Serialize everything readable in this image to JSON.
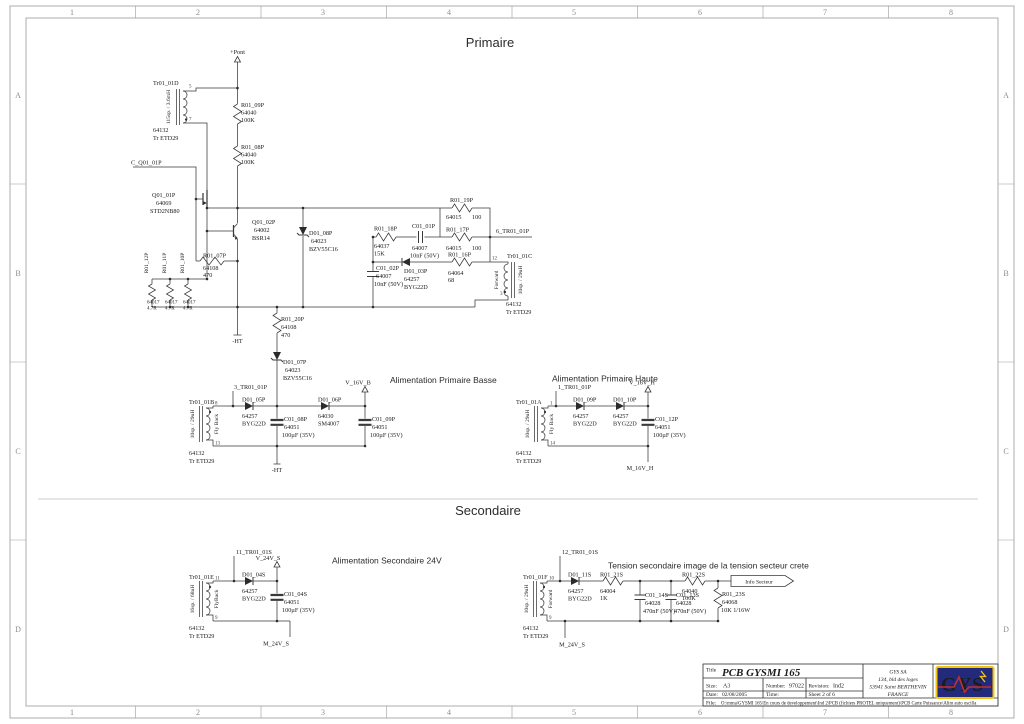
{
  "frame": {
    "columns": [
      "1",
      "2",
      "3",
      "4",
      "5",
      "6",
      "7",
      "8"
    ],
    "rows": [
      "A",
      "B",
      "C",
      "D"
    ]
  },
  "headers": {
    "primaire": "Primaire",
    "secondaire": "Secondaire",
    "alim_basse": "Alimentation Primaire Basse",
    "alim_haute": "Alimentation Primaire Haute",
    "alim_sec24": "Alimentation Secondaire 24V",
    "tension_sec": "Tension secondaire image de la tension secteur crete"
  },
  "nets": {
    "pont": "+Pont",
    "c_q01": "C_Q01_01P",
    "tr6": "6_TR01_01P",
    "tr3": "3_TR01_01P",
    "v16b": "V_16V_B",
    "tr1": "1_TR01_01P",
    "v16h": "V_16V_H",
    "m16h": "M_16V_H",
    "tr11": "11_TR01_01S",
    "v24": "V_24V_S",
    "m24": "M_24V_S",
    "tr12": "12_TR01_01S",
    "ht": "-HT",
    "info": "Info Secteur"
  },
  "components": {
    "tr01_01d": {
      "ref": "Tr01_01D",
      "part": "64132",
      "type": "Tr ETD29",
      "winding": "115sp. / 3.6mH",
      "pin_a": "5",
      "pin_b": "7"
    },
    "tr01_01c": {
      "ref": "Tr01_01C",
      "part": "64132",
      "type": "Tr ETD29",
      "winding": "10sp. / 29uH",
      "mode": "Forward",
      "pin_a": "12",
      "pin_b": "3"
    },
    "tr01_01b": {
      "ref": "Tr01_01B",
      "part": "64132",
      "type": "Tr ETD29",
      "winding": "10sp. / 29uH",
      "mode": "Fly Back",
      "pin_a": "8",
      "pin_b": "13"
    },
    "tr01_01a": {
      "ref": "Tr01_01A",
      "part": "64132",
      "type": "Tr ETD29",
      "winding": "10sp. / 29uH",
      "mode": "Fly Back",
      "pin_a": "1",
      "pin_b": "14"
    },
    "tr01_01e": {
      "ref": "Tr01_01E",
      "part": "64132",
      "type": "Tr ETD29",
      "winding": "16sp. / 68uH",
      "mode": "FlyBack",
      "pin_a": "11",
      "pin_b": "9"
    },
    "tr01_01f": {
      "ref": "Tr01_01F",
      "part": "64132",
      "type": "Tr ETD29",
      "winding": "10sp. / 29uH",
      "mode": "Forward",
      "pin_a": "10",
      "pin_b": "9"
    },
    "q01_01p": {
      "ref": "Q01_01P",
      "part": "64069",
      "val": "STD2NB80"
    },
    "q01_02p": {
      "ref": "Q01_02P",
      "part": "64002",
      "val": "BSR14"
    },
    "r01_09p": {
      "ref": "R01_09P",
      "part": "64040",
      "val": "100K"
    },
    "r01_08p": {
      "ref": "R01_08P",
      "part": "64040",
      "val": "100K"
    },
    "r01_12p": {
      "ref": "R01_12P",
      "part": "64017",
      "val": "4.7R"
    },
    "r01_11p": {
      "ref": "R01_11P",
      "part": "64017",
      "val": "4.7R"
    },
    "r01_10p": {
      "ref": "R01_10P",
      "part": "64017",
      "val": "4.7R"
    },
    "r01_07p": {
      "ref": "R01_07P",
      "part": "64108",
      "val": "470"
    },
    "r01_20p": {
      "ref": "R01_20P",
      "part": "64108",
      "val": "470"
    },
    "r01_18p": {
      "ref": "R01_18P",
      "part": "64037",
      "val": "15K"
    },
    "r01_19p": {
      "ref": "R01_19P",
      "part": "64015",
      "val": "100"
    },
    "r01_17p": {
      "ref": "R01_17P",
      "part": "64015",
      "val": "100"
    },
    "r01_16p": {
      "ref": "R01_16P",
      "part": "64064",
      "val": "68"
    },
    "r01_21s": {
      "ref": "R01_21S",
      "part": "64004",
      "val": "1K"
    },
    "r01_22s": {
      "ref": "R01_22S",
      "part": "64040",
      "val": "100K"
    },
    "r01_23s": {
      "ref": "R01_23S",
      "part": "64068",
      "val": "10K 1/16W"
    },
    "d01_08p": {
      "ref": "D01_08P",
      "part": "64023",
      "val": "BZV55C16"
    },
    "d01_07p": {
      "ref": "D01_07P",
      "part": "64023",
      "val": "BZV55C16"
    },
    "d01_03p": {
      "ref": "D01_03P",
      "part": "64257",
      "val": "BYG22D"
    },
    "d01_05p": {
      "ref": "D01_05P",
      "part": "64257",
      "val": "BYG22D"
    },
    "d01_06p": {
      "ref": "D01_06P",
      "part": "64030",
      "val": "SM4007"
    },
    "d01_09p": {
      "ref": "D01_09P",
      "part": "64257",
      "val": "BYG22D"
    },
    "d01_10p": {
      "ref": "D01_10P",
      "part": "64257",
      "val": "BYG22D"
    },
    "d01_04s": {
      "ref": "D01_04S",
      "part": "64257",
      "val": "BYG22D"
    },
    "d01_11s": {
      "ref": "D01_11S",
      "part": "64257",
      "val": "BYG22D"
    },
    "c01_01p": {
      "ref": "C01_01P",
      "part": "64007",
      "val": "10nF (50V)"
    },
    "c01_02p": {
      "ref": "C01_02P",
      "part": "64007",
      "val": "10nF (50V)"
    },
    "c01_08p": {
      "ref": "C01_08P",
      "part": "64051",
      "val": "100µF (35V)"
    },
    "c01_09p": {
      "ref": "C01_09P",
      "part": "64051",
      "val": "100µF (35V)"
    },
    "c01_12p": {
      "ref": "C01_12P",
      "part": "64051",
      "val": "100µF (35V)"
    },
    "c01_04s": {
      "ref": "C01_04S",
      "part": "64051",
      "val": "100µF (35V)"
    },
    "c01_14s": {
      "ref": "C01_14S",
      "part": "64028",
      "val": "470nF (50V)"
    },
    "c01_13s": {
      "ref": "C01_13S",
      "part": "64028",
      "val": "470nF (50V)"
    }
  },
  "title_block": {
    "title_label": "Title",
    "title": "PCB GYSMI 165",
    "size_label": "Size:",
    "size": "A3",
    "number_label": "Number:",
    "number": "97022",
    "revision_label": "Revision:",
    "revision": "Ind2",
    "date_label": "Date:",
    "date": "02/08/2005",
    "time_label": "Time:",
    "sheet": "Sheet 2  of  6",
    "file_label": "File:",
    "file_path": "O:\\mma\\GYSMI 165\\En cours de developpement\\Ind 2\\PCB (fichiers PROTEL uniquement)\\PCB Carte Puissance\\Alim auto oscilla",
    "company": [
      "GYS SA",
      "134, bld des loges",
      "53941 Saint BERTHEVIN",
      "FRANCE"
    ],
    "logo_text": "GYS"
  },
  "colors": {
    "wire": "#3a3a3a",
    "frame": "#9a9a9a",
    "logo_bg": "#232a7c",
    "logo_yellow": "#f2c40f",
    "logo_red": "#c03030"
  }
}
